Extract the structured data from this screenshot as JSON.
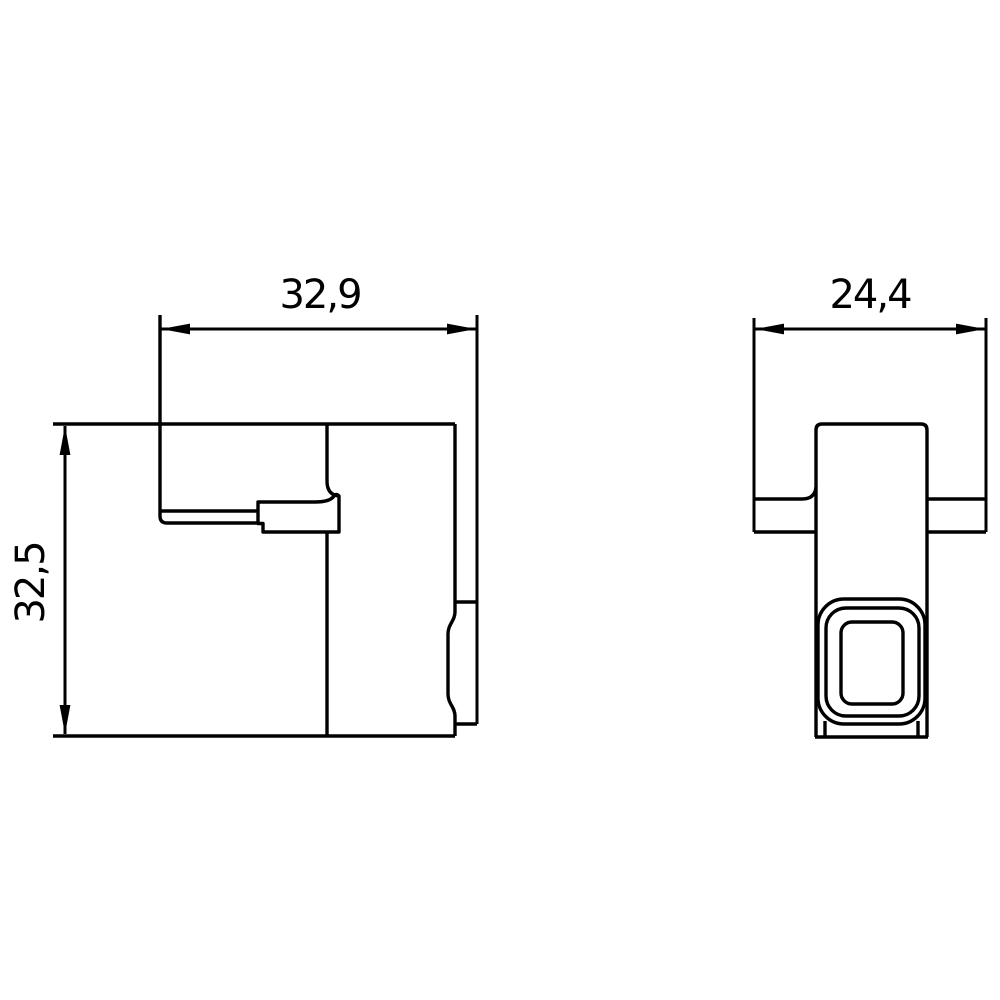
{
  "drawing": {
    "background_color": "#ffffff",
    "line_color": "#000000",
    "text_color": "#000000",
    "dimensions": {
      "side_view_width": {
        "label": "32,9"
      },
      "side_view_height": {
        "label": "32,5"
      },
      "front_view_width": {
        "label": "24,4"
      }
    }
  }
}
